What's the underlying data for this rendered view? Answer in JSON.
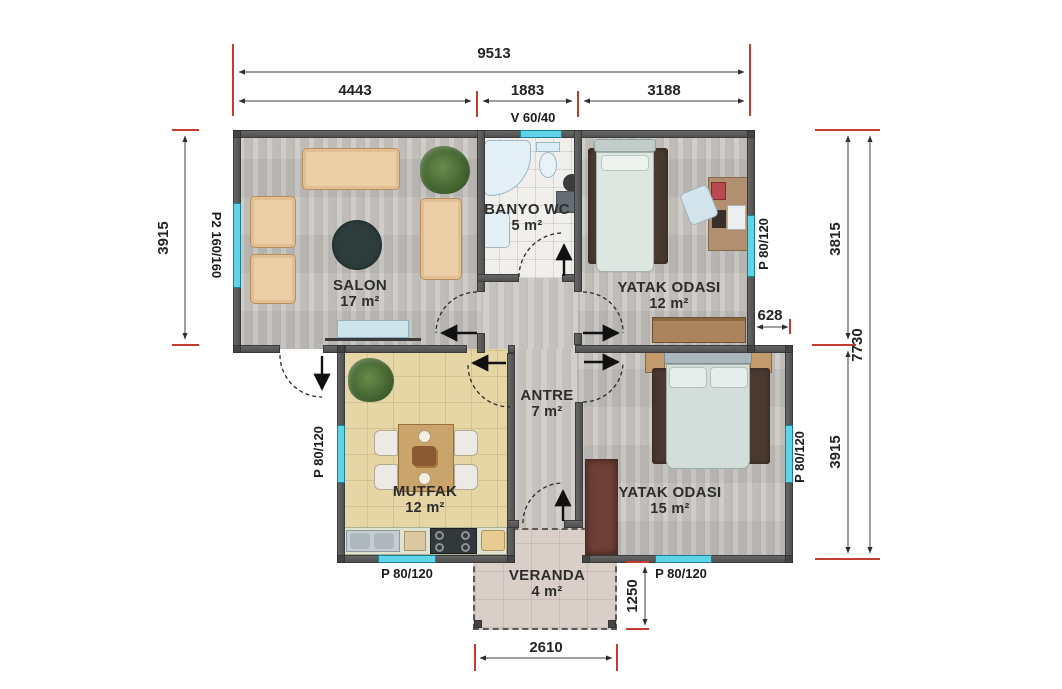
{
  "plan": {
    "dims": {
      "total_width": "9513",
      "seg_salon": "4443",
      "seg_banyo": "1883",
      "seg_bed": "3188",
      "salon_height": "3915",
      "right_upper": "3815",
      "total_height": "7730",
      "offset": "628",
      "right_lower": "3915",
      "veranda_height": "1250",
      "veranda_width": "2610"
    },
    "windows": {
      "top": "V 60/40",
      "salon_left": "P2 160/160",
      "bed1_right": "P 80/120",
      "mutfak_left": "P 80/120",
      "mutfak_bottom": "P 80/120",
      "bed2_bottom": "P 80/120",
      "bed2_right": "P 80/120"
    },
    "rooms": {
      "salon": {
        "name": "SALON",
        "area": "17 m²"
      },
      "banyo": {
        "name": "BANYO WC",
        "area": "5 m²"
      },
      "bed1": {
        "name": "YATAK ODASI",
        "area": "12 m²"
      },
      "antre": {
        "name": "ANTRE",
        "area": "7 m²"
      },
      "mutfak": {
        "name": "MUTFAK",
        "area": "12 m²"
      },
      "bed2": {
        "name": "YATAK ODASI",
        "area": "15 m²"
      },
      "veranda": {
        "name": "VERANDA",
        "area": "4 m²"
      }
    },
    "colors": {
      "dimension_tick": "#c43c30",
      "window": "#5fd4e6",
      "wall": "#585858",
      "wood_floor": "#c8c5c1",
      "kitchen_floor": "#e6d6a6",
      "bath_floor": "#f1efec",
      "veranda_floor": "#d9cec8"
    }
  }
}
